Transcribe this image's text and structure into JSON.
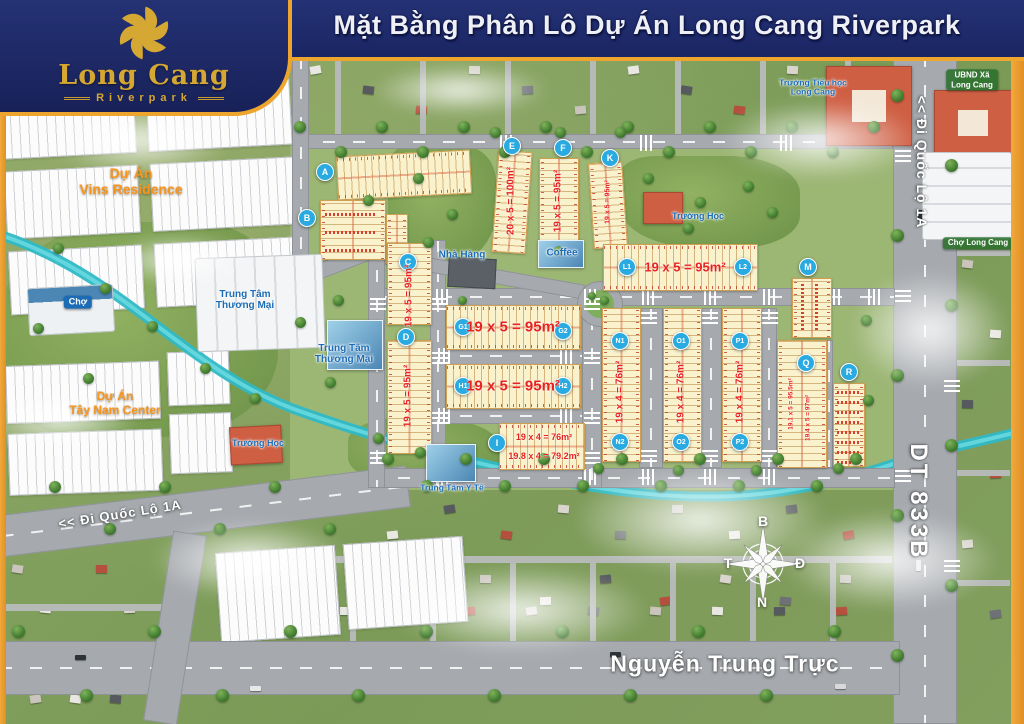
{
  "header": {
    "title": "Mặt Bằng Phân Lô Dự Án Long Cang Riverpark"
  },
  "logo": {
    "name": "Long Cang",
    "tagline": "Riverpark"
  },
  "roads": {
    "di_quoc_lo_1a_right": "<<  Đi Quốc Lộ 1A",
    "dt_833b": "DT 833B",
    "di_quoc_lo_1a_left": "<< Đi Quốc Lộ 1A",
    "nguyen_trung_truc": "Nguyễn Trung Trực"
  },
  "areas": {
    "vins": {
      "line1": "Dự Án",
      "line2": "Vins Residence"
    },
    "tay_nam": {
      "line1": "Dự Án",
      "line2": "Tây Nam Center"
    },
    "cho": "Chợ",
    "ttm1": {
      "line1": "Trung Tâm",
      "line2": "Thương Mại"
    },
    "ttm2": {
      "line1": "Trung Tâm",
      "line2": "Thương Mại"
    },
    "nha_hang": "Nhà Hàng",
    "coffee": "Coffee",
    "truong_hoc_1": "Trường Học",
    "truong_hoc_2": "Trường Học",
    "truong_tieu_hoc": {
      "line1": "Trường Tiểu học",
      "line2": "Long Cang"
    },
    "ubnd": {
      "line1": "UBND Xã",
      "line2": "Long Cang"
    },
    "cho_long_cang": "Chợ Long Cang",
    "y_te": "Trung Tâm Y Tế"
  },
  "compass": {
    "n": "B",
    "e": "Đ",
    "s": "N",
    "w": "T"
  },
  "markers": {
    "a": "A",
    "b": "B",
    "c": "C",
    "d": "D",
    "e": "E",
    "f": "F",
    "k": "K",
    "g1": "G1",
    "g2": "G2",
    "h1": "H1",
    "h2": "H2",
    "i": "I",
    "l1": "L1",
    "l2": "L2",
    "m": "M",
    "n1": "N1",
    "n2": "N2",
    "o1": "O1",
    "o2": "O2",
    "p1": "P1",
    "p2": "P2",
    "q": "Q",
    "r": "R"
  },
  "lot_sizes": {
    "c": "19 x 5 = 95m²",
    "d": "19 x 5 = 95m²",
    "e": "20 x 5 = 100m²",
    "f": "19 x 5 = 95m²",
    "k": "19 x 5 = 95m²",
    "g": "19 x 5 = 95m²",
    "h": "19 x 5 = 95m²",
    "l": "19 x 5 = 95m²",
    "i1": "19 x 4 = 76m²",
    "i2": "19.8 x 4 = 79.2m²",
    "n": "19 x 4 = 76m²",
    "o": "19 x 4 = 76m²",
    "p": "19 x 4 = 76m²",
    "q1": "19.1 x 5 = 95.5m²",
    "q2": "19.4 x 5 = 97m²"
  },
  "colors": {
    "navy": "#1e2a6e",
    "gold": "#eda52d",
    "logo_gold": "#d5a733",
    "lot_yellow": "#f9f2cd",
    "size_red": "#e8221c",
    "marker_blue": "#29aae1",
    "river_teal": "#35c3ce",
    "label_blue": "#1b6cb5",
    "label_orange": "#f7941d",
    "pill_green": "#2a702c"
  }
}
